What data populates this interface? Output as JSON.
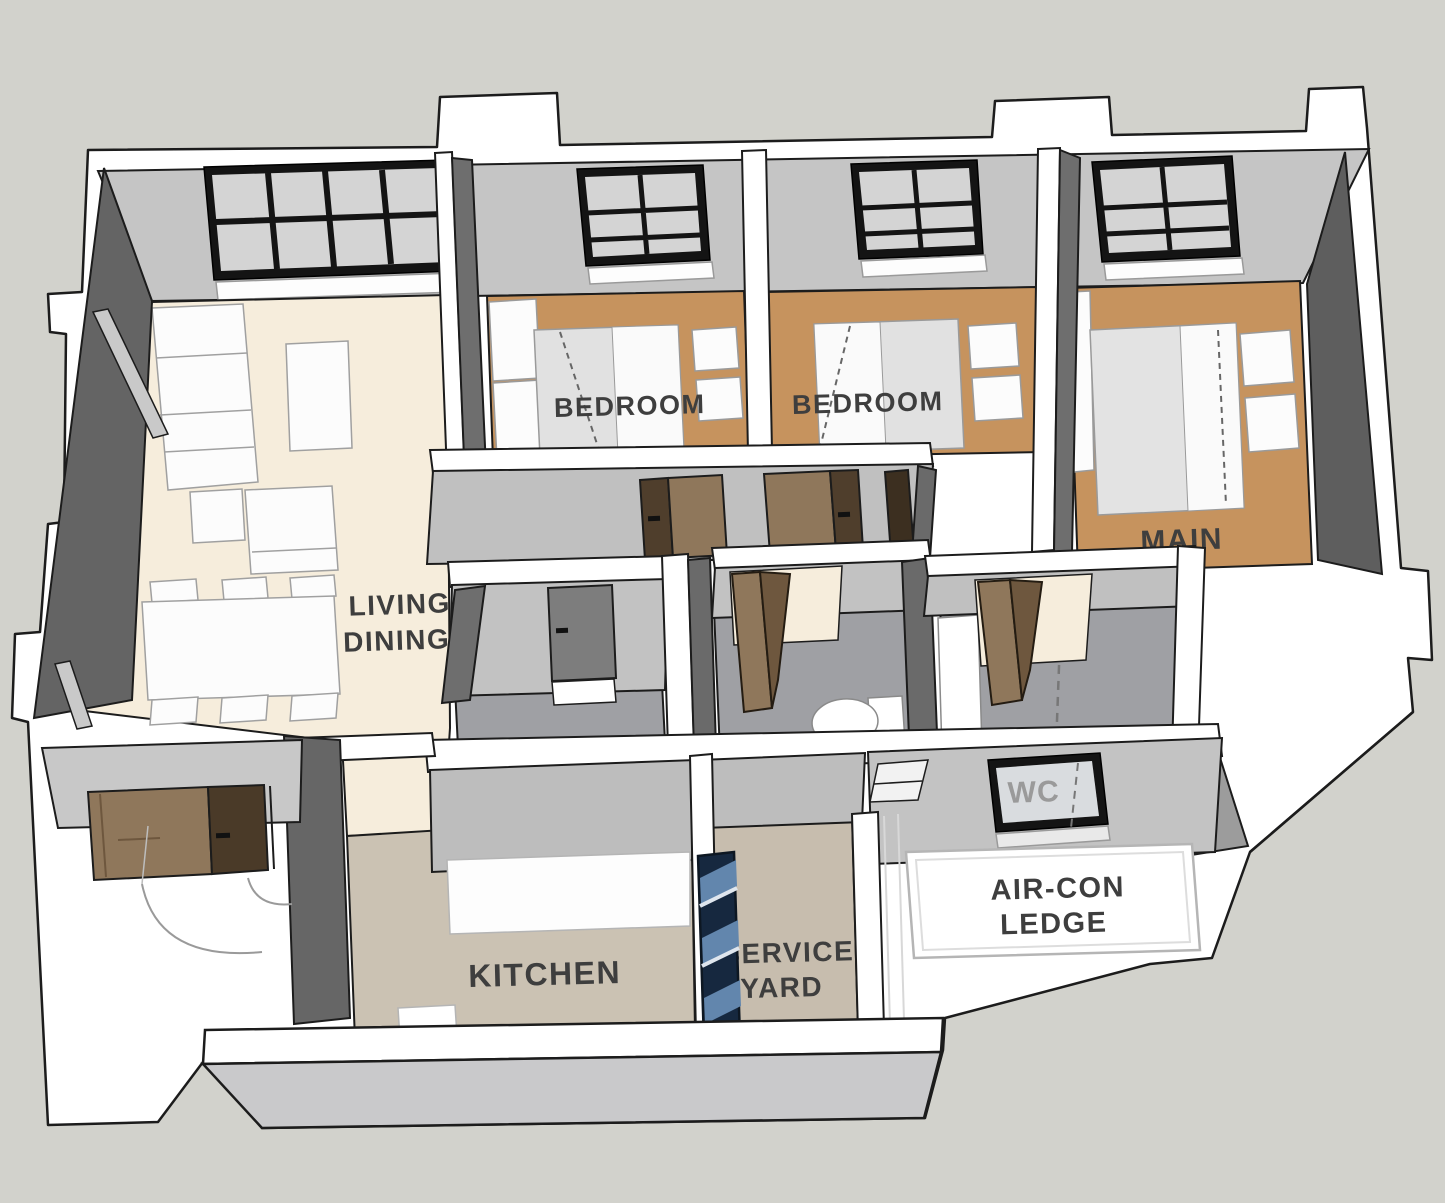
{
  "scene": {
    "title": "3D isometric apartment floor plan",
    "background_color": "#d2d2cc",
    "wall_top_color": "#ffffff",
    "wall_face_light": "#c4c4c4",
    "wall_face_dark": "#646464",
    "window_frame_color": "#141414",
    "door_color": "#8f775b",
    "door_dark_color": "#5e4a34"
  },
  "rooms": {
    "living": {
      "line1": "LIVING",
      "line2": "DINING",
      "floor_color": "#f6eddc"
    },
    "bedroom1": {
      "label": "BEDROOM",
      "floor_color": "#c6935e"
    },
    "bedroom2": {
      "label": "BEDROOM",
      "floor_color": "#c6935e"
    },
    "main": {
      "label": "MAIN",
      "floor_color": "#c6935e"
    },
    "household_shelter": {
      "label": "HOUSE",
      "floor_color": "#9fa0a4"
    },
    "bath1": {
      "label": "BATH",
      "floor_color": "#9fa0a4"
    },
    "bath2": {
      "label": "BATH",
      "floor_color": "#9fa0a4"
    },
    "wc": {
      "label": "WC"
    },
    "kitchen": {
      "label": "KITCHEN",
      "floor_color": "#cbc2b3"
    },
    "service_yard": {
      "line1": "SERVICE",
      "line2": "YARD",
      "floor_color": "#c7bdae"
    },
    "aircon_ledge": {
      "line1": "AIR-CON",
      "line2": "LEDGE",
      "floor_color": "#ffffff"
    }
  }
}
